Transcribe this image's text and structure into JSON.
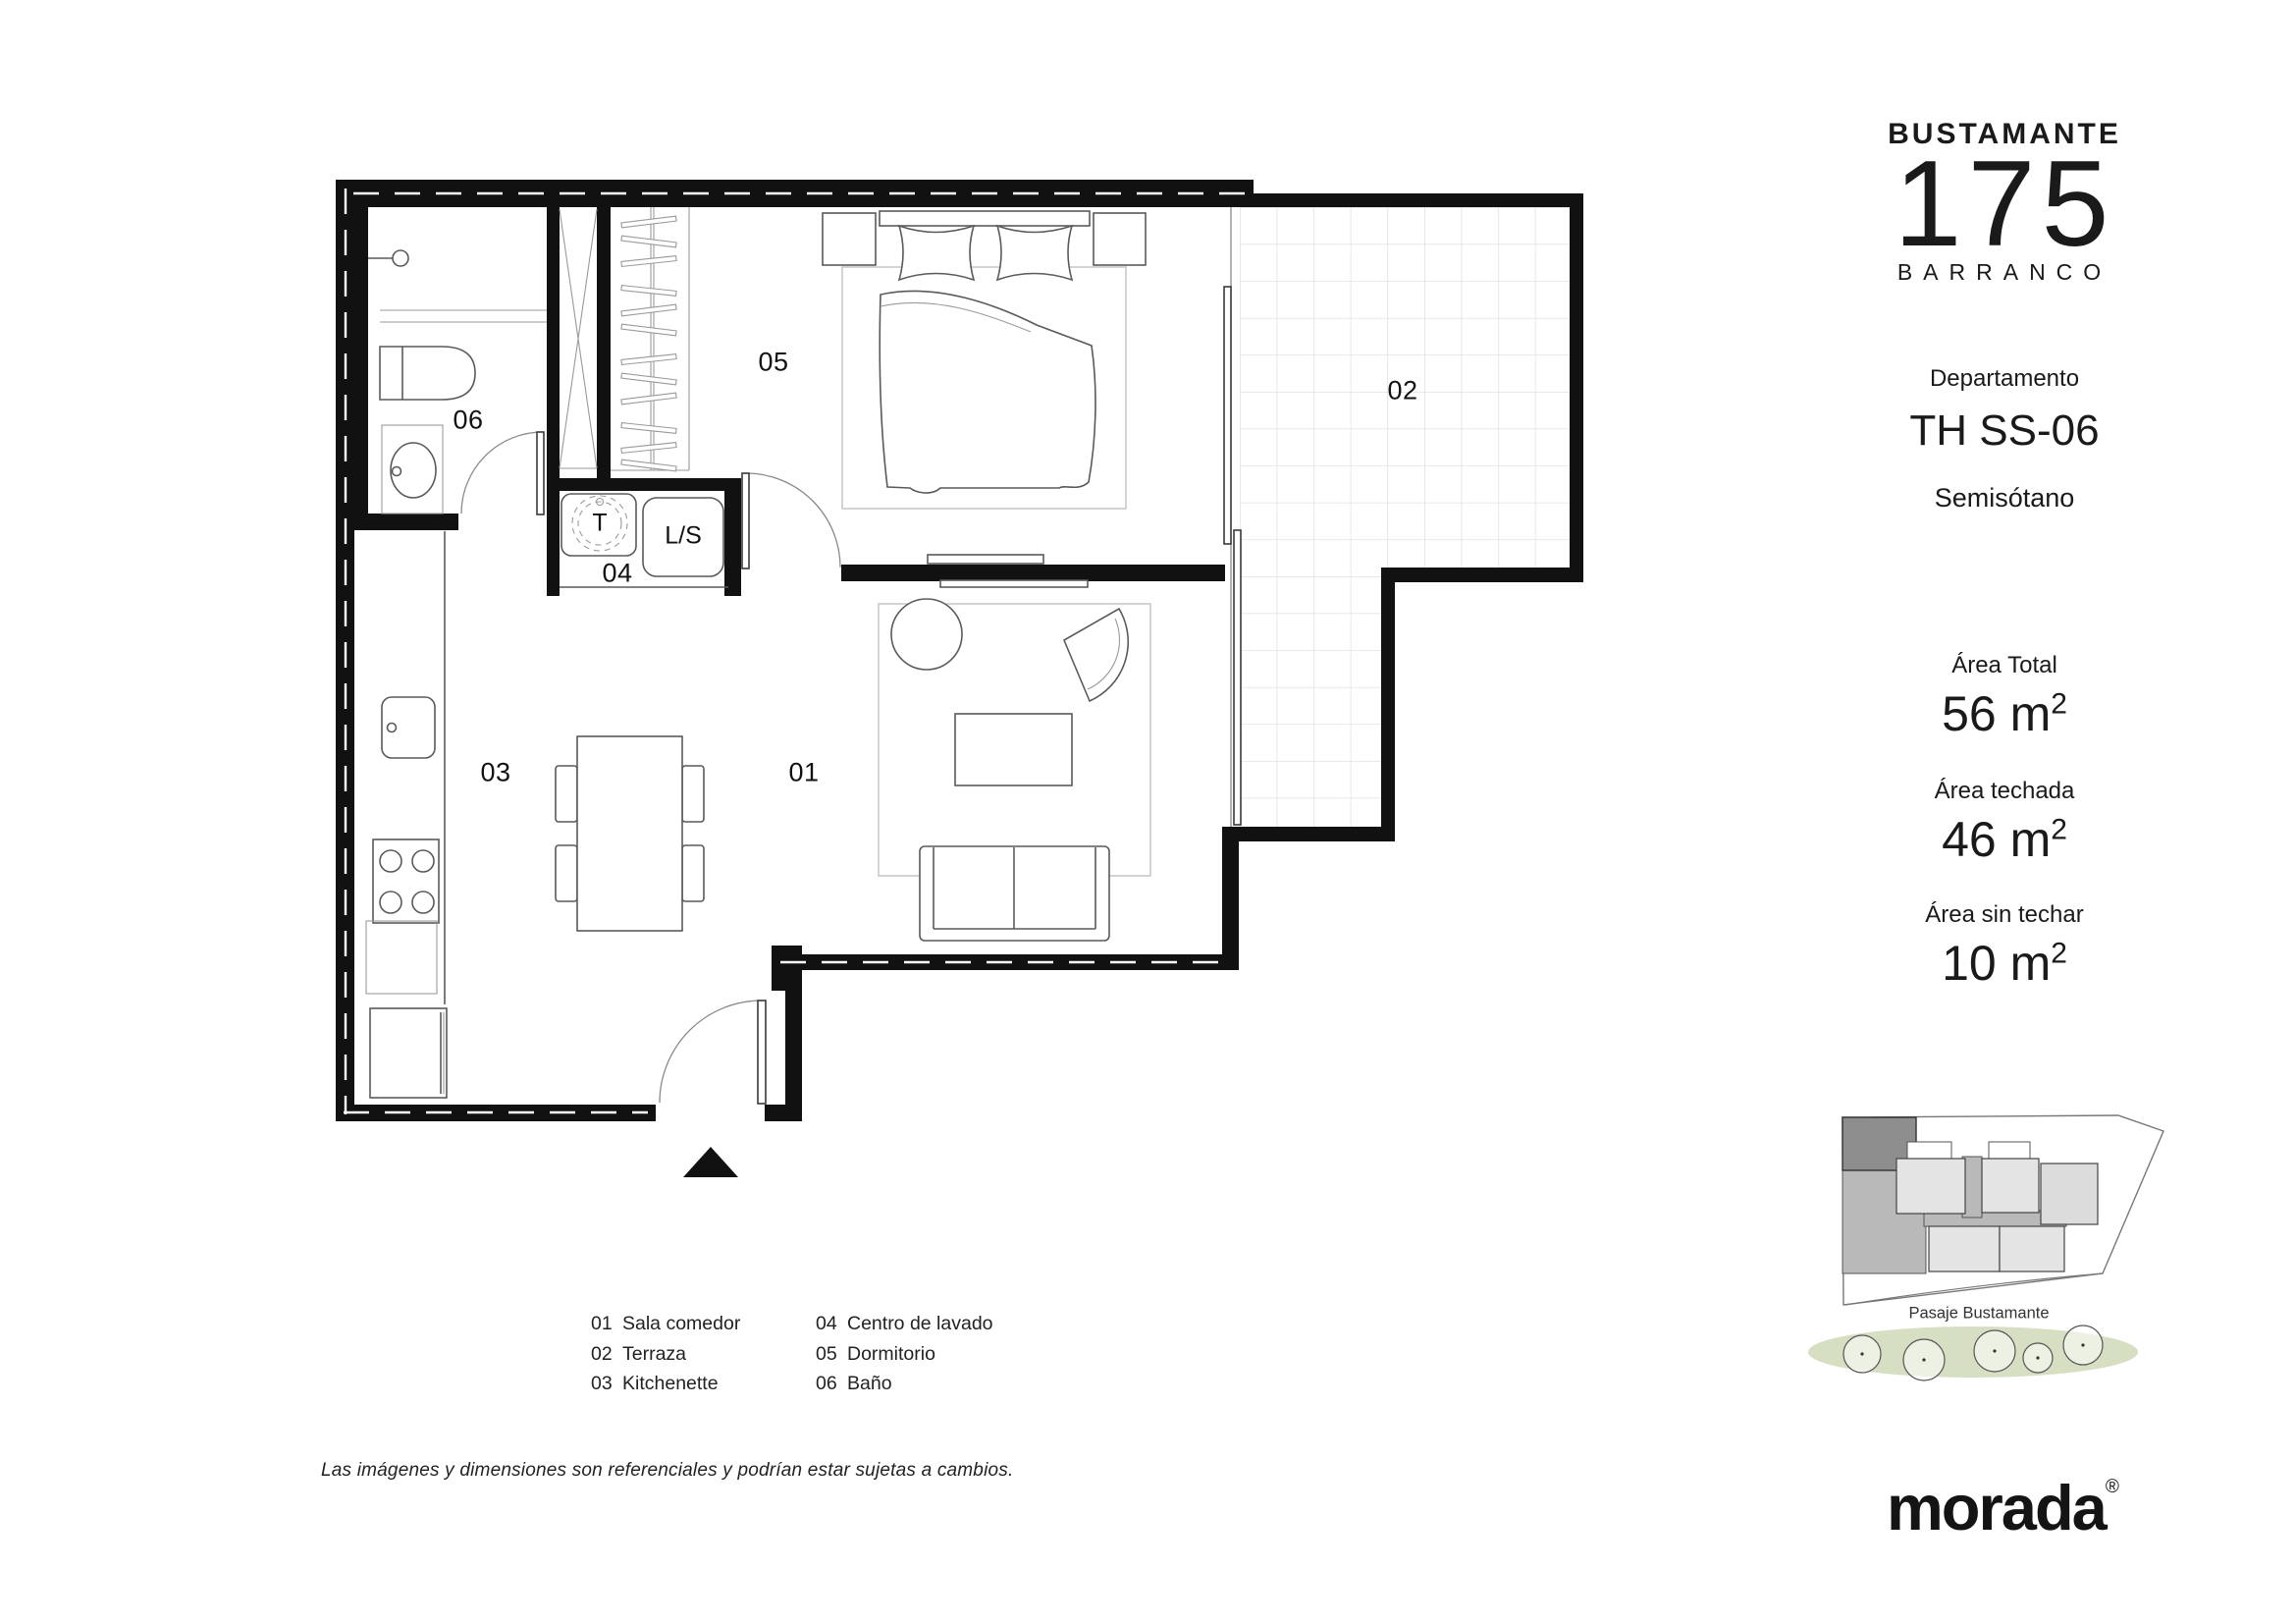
{
  "branding": {
    "project_name": "BUSTAMANTE",
    "project_number": "175",
    "district": "BARRANCO"
  },
  "unit": {
    "label": "Departamento",
    "code": "TH SS-06",
    "level": "Semisótano"
  },
  "areas": [
    {
      "label": "Área Total",
      "value": "56",
      "unit": " m",
      "sup": "2"
    },
    {
      "label": "Área techada",
      "value": "46",
      "unit": " m",
      "sup": "2"
    },
    {
      "label": "Área sin techar",
      "value": "10",
      "unit": " m",
      "sup": "2"
    }
  ],
  "plan": {
    "room_labels": {
      "sala_comedor": "01",
      "terraza": "02",
      "kitchenette": "03",
      "centro_lavado": "04",
      "dormitorio": "05",
      "bano": "06"
    },
    "appliance_labels": {
      "therma": "T",
      "lavadora_secadora": "L/S"
    }
  },
  "legend": {
    "items": [
      {
        "num": "01",
        "label": "Sala comedor"
      },
      {
        "num": "02",
        "label": "Terraza"
      },
      {
        "num": "03",
        "label": "Kitchenette"
      },
      {
        "num": "04",
        "label": "Centro de lavado"
      },
      {
        "num": "05",
        "label": "Dormitorio"
      },
      {
        "num": "06",
        "label": "Baño"
      }
    ]
  },
  "site_map": {
    "street_label": "Pasaje Bustamante"
  },
  "disclaimer": "Las imágenes y dimensiones son referenciales y podrían estar sujetas a cambios.",
  "footer_logo": {
    "name": "morada",
    "registered": "®"
  },
  "colors": {
    "wall": "#111111",
    "text": "#1a1a1a",
    "furniture_stroke": "#5a5a5a",
    "light_stroke": "#9a9a9a",
    "rug_stroke": "#c9c9c9",
    "tile_grid": "#dcdcdc",
    "site_green": "#cfd9b7",
    "site_dark_unit": "#8e8e8e",
    "site_medium_unit": "#b9b9b9",
    "site_light_unit": "#e4e4e4"
  }
}
